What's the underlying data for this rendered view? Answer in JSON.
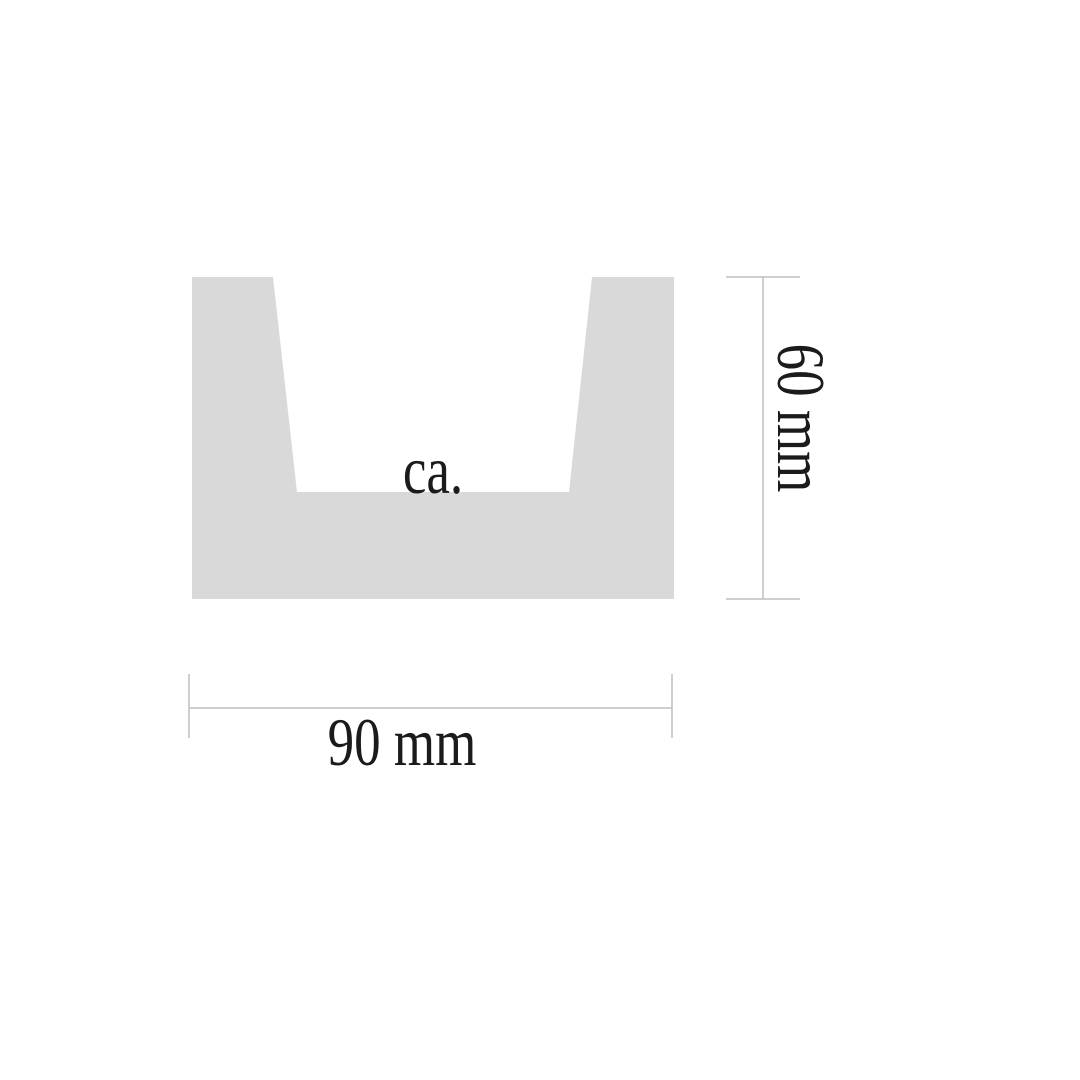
{
  "page": {
    "background_color": "#ffffff"
  },
  "diagram": {
    "kind": "u-channel-profile-cross-section",
    "shape": {
      "fill_color": "#d9d9d9"
    },
    "dimension_line_color": "#bfbfbf",
    "text_color": "#1b1b1b",
    "labels": {
      "approx_note": "ca.",
      "height": "60 mm",
      "width": "90 mm"
    }
  }
}
